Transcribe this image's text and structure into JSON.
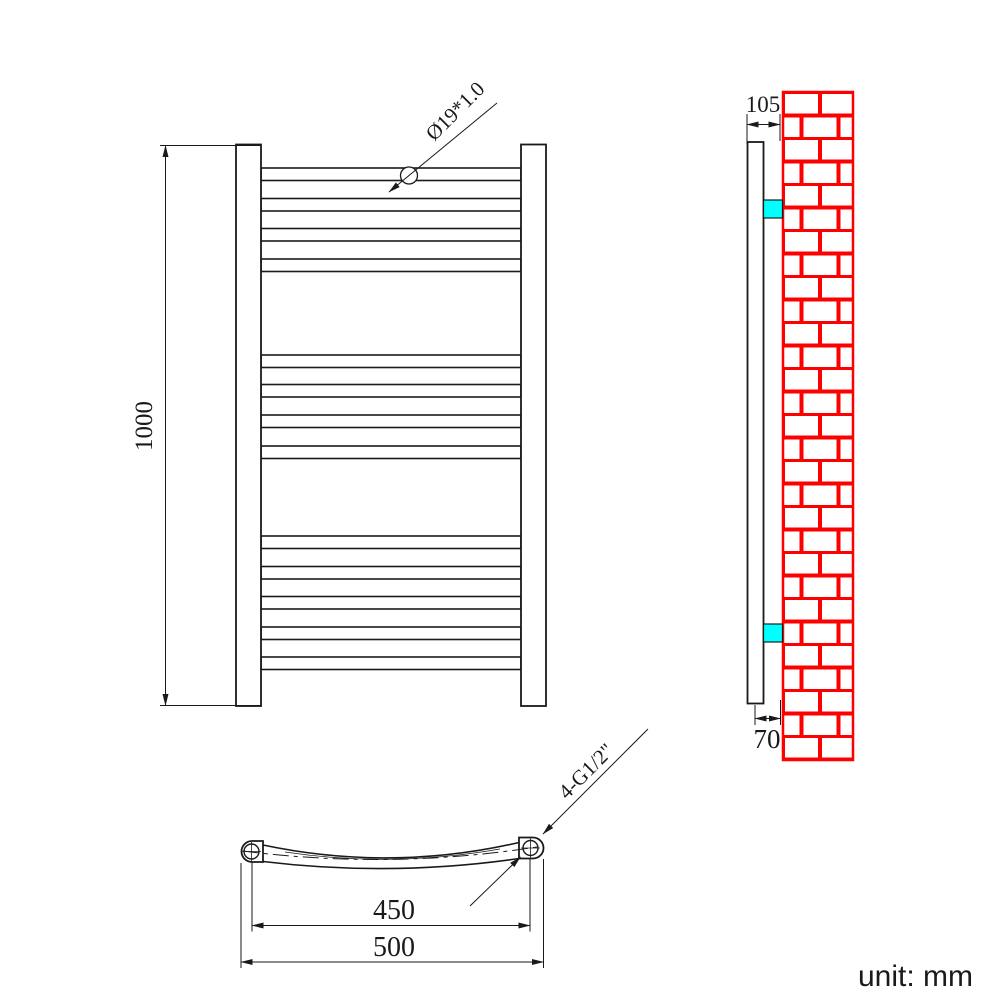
{
  "unit_note": "unit: mm",
  "front_view": {
    "height_dim": "1000",
    "tube_spec": "Ø19*1.0",
    "tube_count": 13,
    "tube_groups": [
      4,
      4,
      5
    ]
  },
  "side_view": {
    "depth_dim": "105",
    "center_depth_dim": "70"
  },
  "bottom_view": {
    "thread_spec": "4-G1/2\"",
    "centers_dim": "450",
    "overall_width_dim": "500"
  },
  "colors": {
    "line": "#1a1a1a",
    "brick_red": "#ff0000",
    "bracket_cyan": "#00ffff",
    "background": "#ffffff"
  }
}
